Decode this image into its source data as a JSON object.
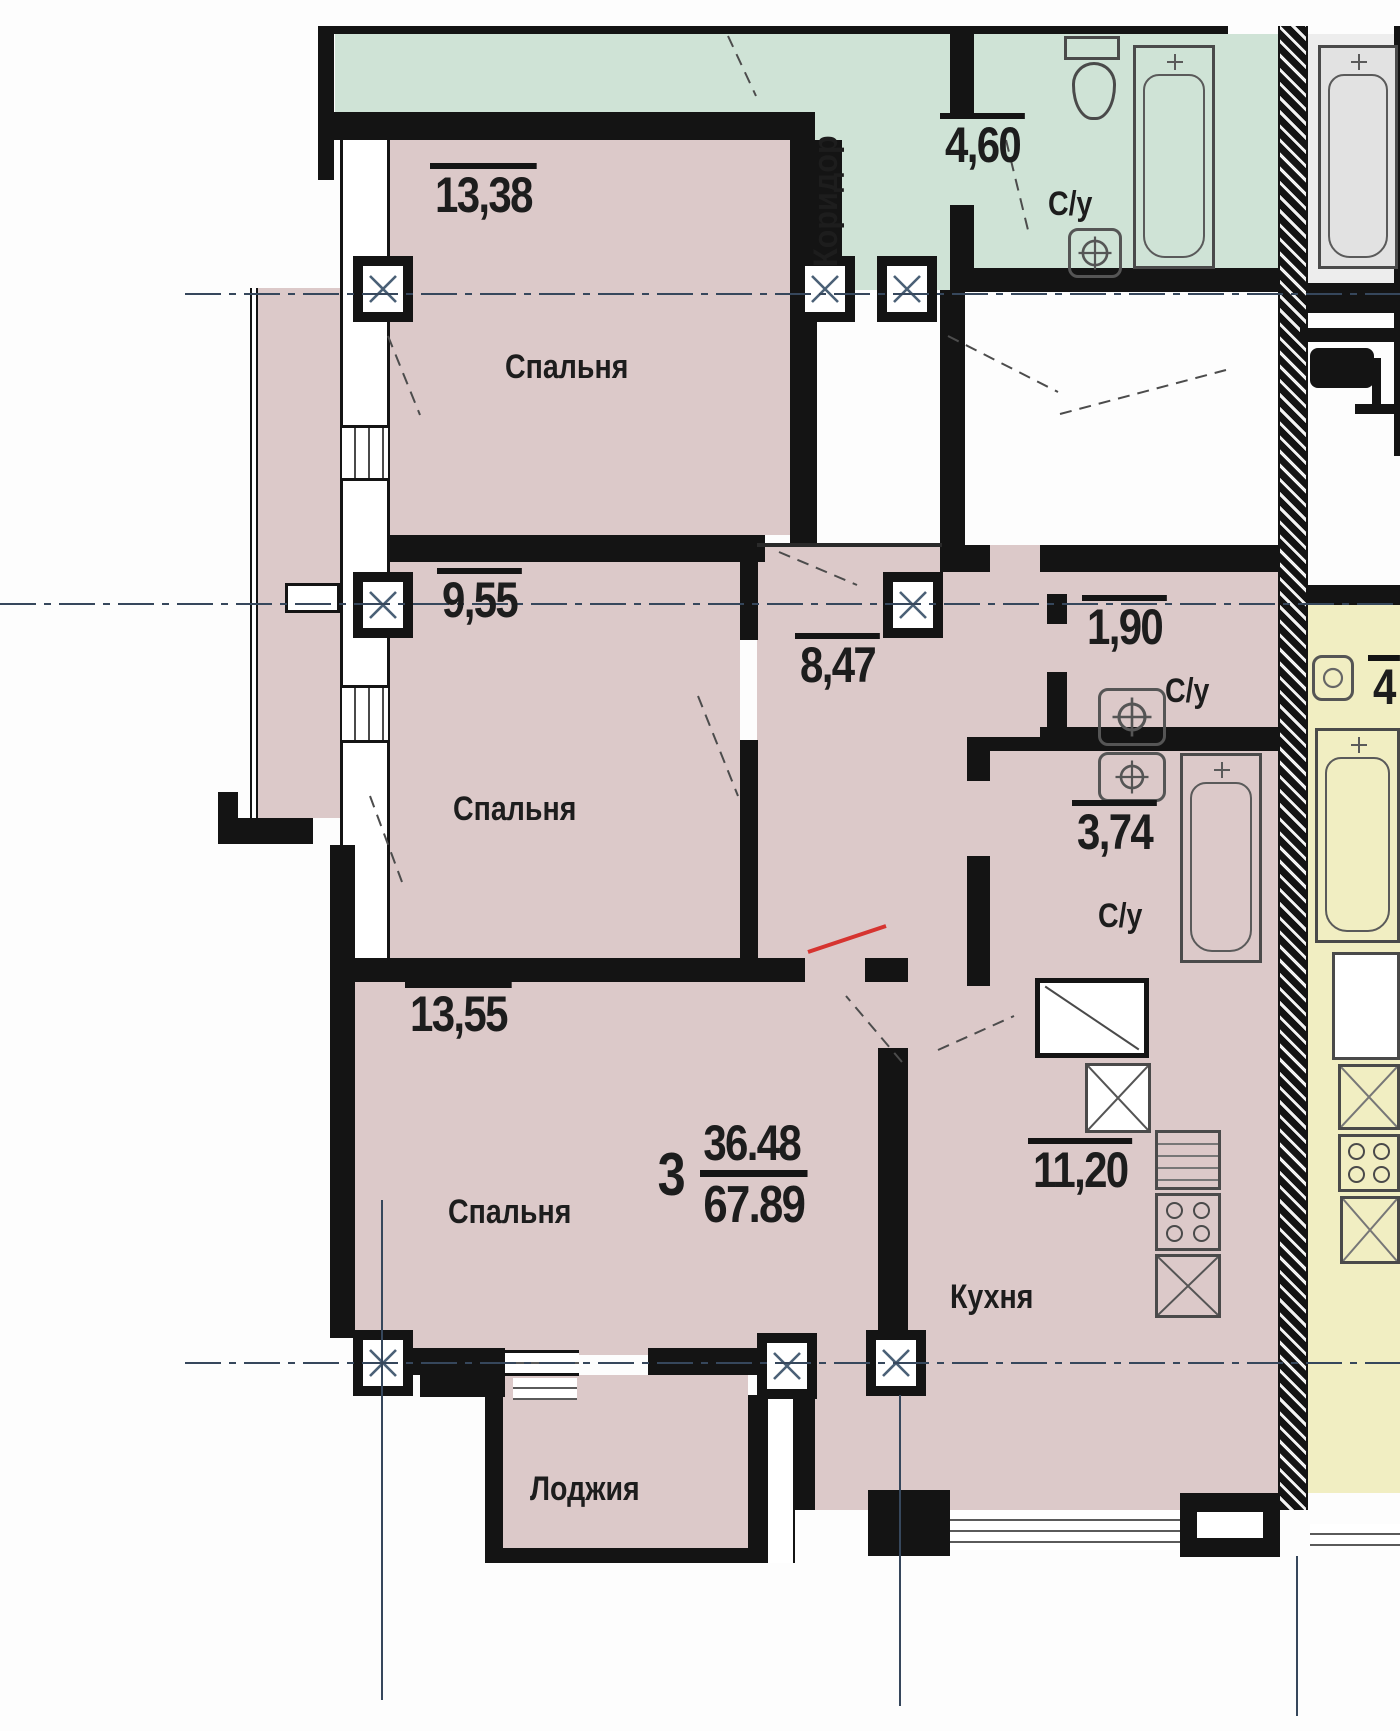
{
  "apartment": {
    "number": "3",
    "living_area": "36.48",
    "total_area": "67.89"
  },
  "rooms": {
    "bedroom1": {
      "name": "Спальня",
      "area": "13,38"
    },
    "bedroom2": {
      "name": "Спальня",
      "area": "9,55"
    },
    "bedroom3": {
      "name": "Спальня",
      "area": "13,55"
    },
    "hall": {
      "area": "8,47"
    },
    "wc_small": {
      "name": "С/у",
      "area": "1,90"
    },
    "bathroom": {
      "name": "С/у",
      "area": "3,74"
    },
    "kitchen": {
      "name": "Кухня",
      "area": "11,20"
    },
    "loggia": {
      "name": "Лоджия"
    },
    "corridor": {
      "name": "Коридор"
    },
    "wc_common": {
      "name": "С/у",
      "area": "4,60"
    },
    "neighbor": {
      "partial_area": "4"
    }
  },
  "colors": {
    "apartment_fill": "#dcc9c9",
    "common_fill": "#cfe3d6",
    "neighbor_fill": "#f1eec2",
    "neighbor_gray_fill": "#ededed",
    "wall": "#141414",
    "axis": "#36475c",
    "red_mark": "#d63430"
  }
}
